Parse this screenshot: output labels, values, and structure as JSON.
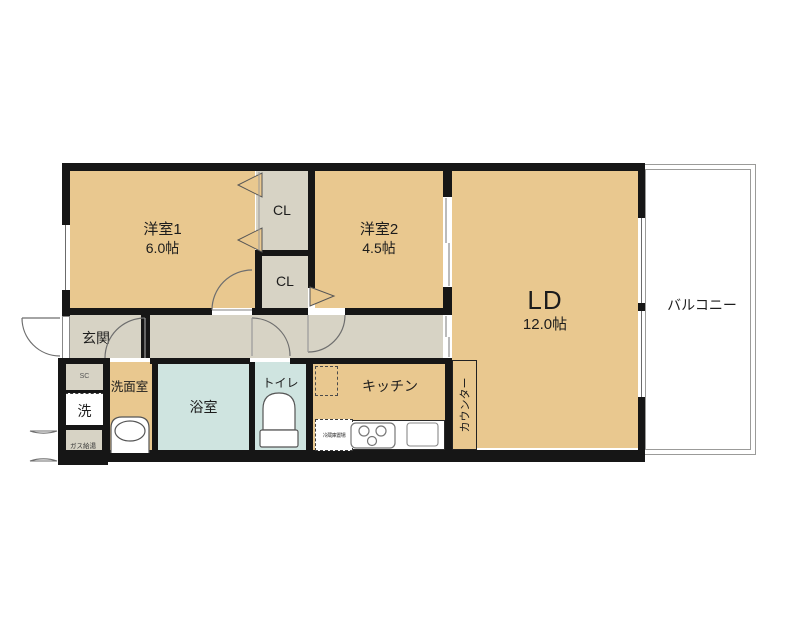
{
  "floorplan": {
    "rooms": {
      "bedroom1": {
        "label": "洋室1",
        "size": "6.0帖"
      },
      "bedroom2": {
        "label": "洋室2",
        "size": "4.5帖"
      },
      "living_dining": {
        "label": "LD",
        "size": "12.0帖"
      },
      "balcony": {
        "label": "バルコニー"
      },
      "entrance": {
        "label": "玄関"
      },
      "washroom": {
        "label": "洗面室"
      },
      "bathroom": {
        "label": "浴室"
      },
      "toilet": {
        "label": "トイレ"
      },
      "kitchen": {
        "label": "キッチン"
      },
      "counter": {
        "label": "カウンター"
      },
      "closet1": {
        "label": "CL"
      },
      "closet2": {
        "label": "CL"
      },
      "shoe_closet": {
        "label": "SC"
      },
      "washer_space": {
        "label": "洗"
      },
      "gas_heater": {
        "label": "ガス給湯"
      },
      "fridge_space": {
        "label": "冷蔵庫置場"
      }
    },
    "colors": {
      "room_fill": "#e9c88f",
      "hall_fill": "#d7d3c5",
      "wet_area_fill": "#cfe4e0",
      "wall": "#161616",
      "balcony_border": "#9b9b99"
    }
  }
}
